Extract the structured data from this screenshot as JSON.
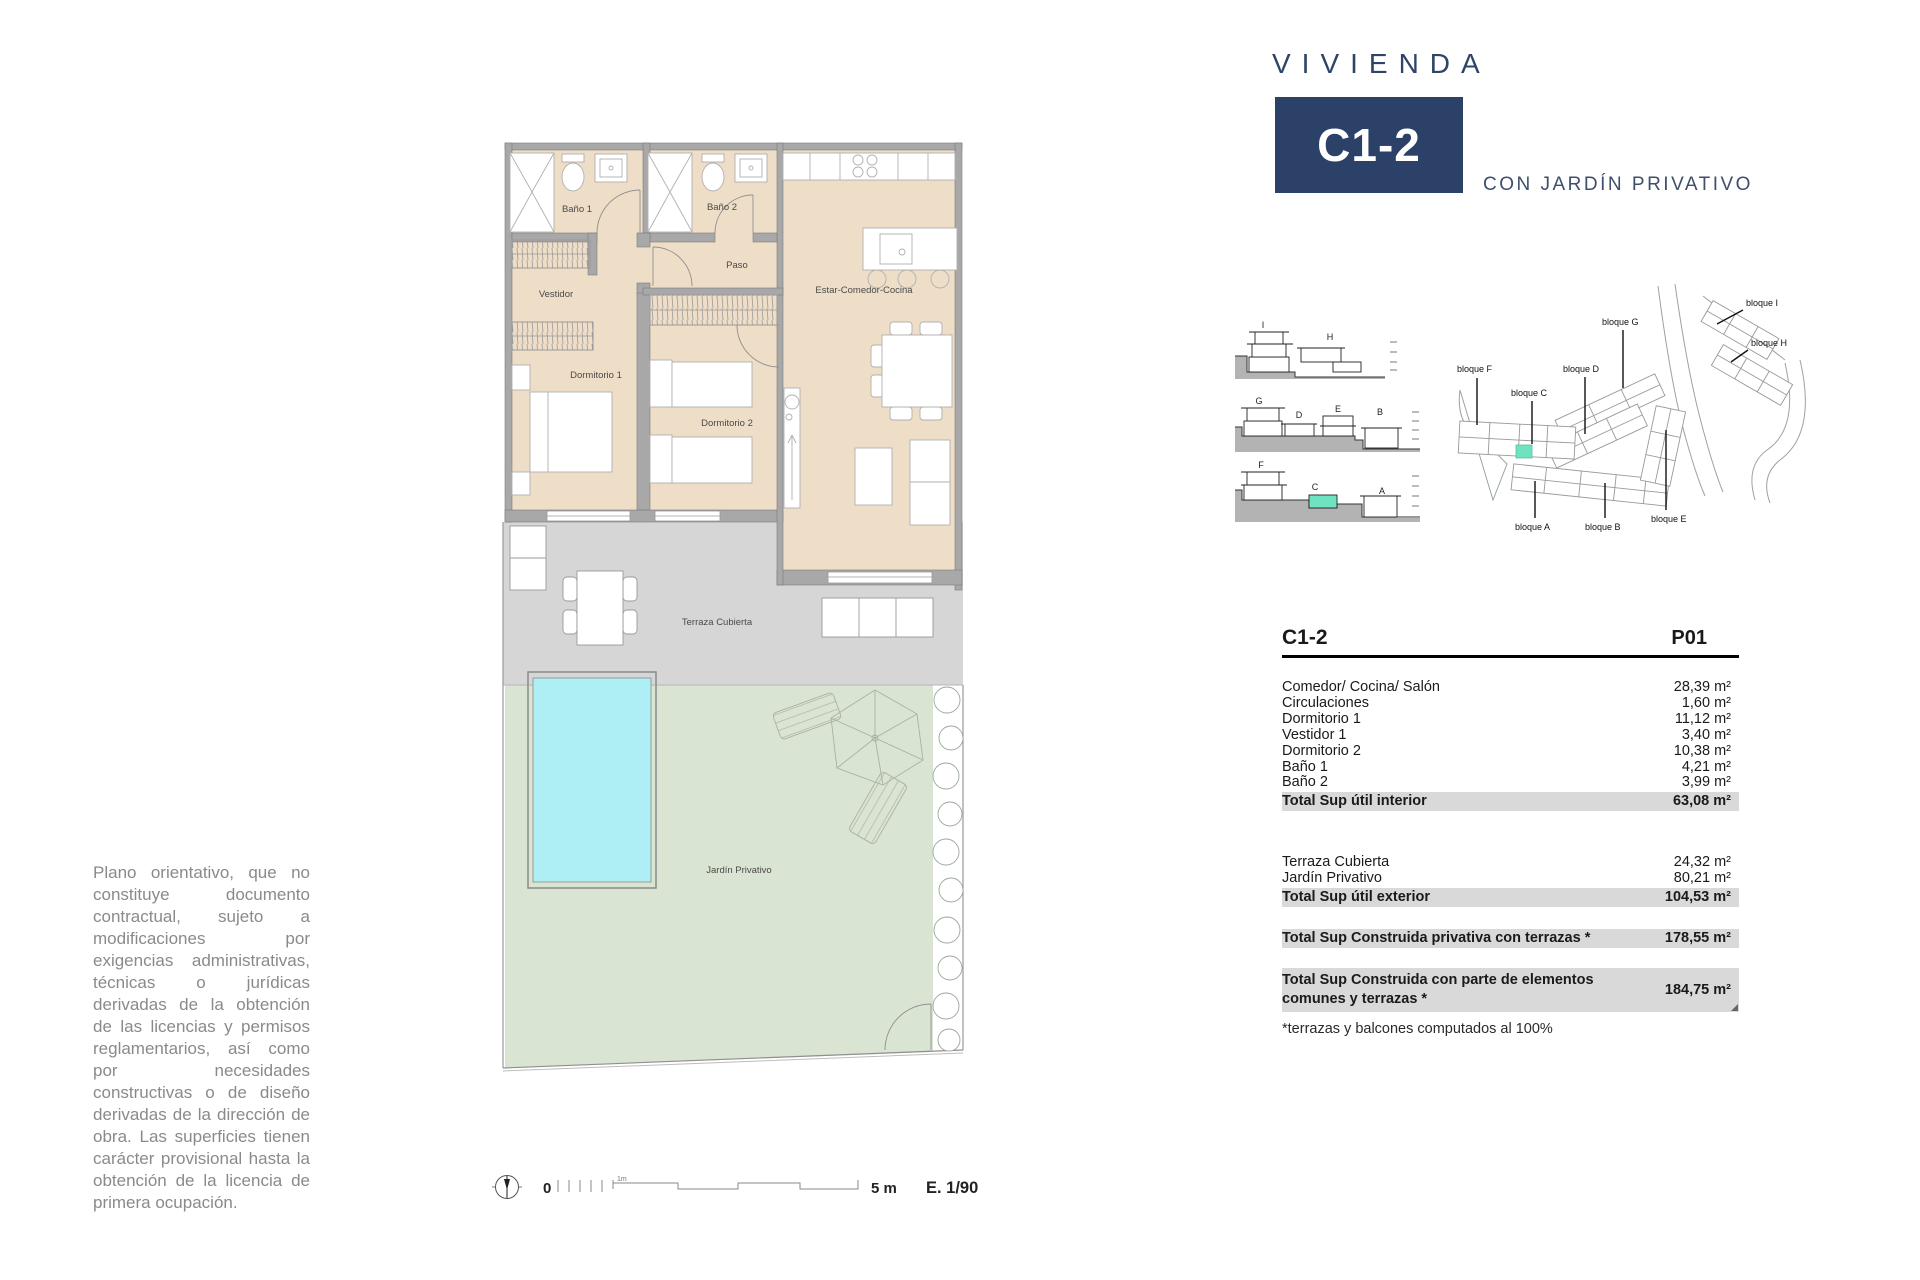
{
  "header": {
    "kicker": "VIVIENDA",
    "unit_code": "C1-2",
    "subtitle": "CON JARDÍN PRIVATIVO",
    "navy": "#2b4168"
  },
  "plan": {
    "room_labels": [
      "Baño 1",
      "Baño 2",
      "Paso",
      "Vestidor",
      "Estar-Comedor-Cocina",
      "Dormitorio 1",
      "Dormitorio 2",
      "Terraza Cubierta",
      "Jardín Privativo"
    ],
    "colors": {
      "floor": "#eeddc7",
      "wall": "#a8a8a8",
      "terrace": "#d6d6d6",
      "garden": "#dae4d3",
      "pool": "#aeeef5",
      "highlight": "#6fe3c1"
    },
    "scale_bar": {
      "zero": "0",
      "one_meter": "1m",
      "five_meters": "5 m",
      "ratio": "E. 1/90"
    }
  },
  "sections": {
    "labels": [
      "I",
      "H",
      "G",
      "D",
      "E",
      "B",
      "F",
      "C",
      "A"
    ]
  },
  "site_plan": {
    "labels": [
      "bloque F",
      "bloque C",
      "bloque D",
      "bloque G",
      "bloque I",
      "bloque H",
      "bloque A",
      "bloque B",
      "bloque E"
    ]
  },
  "area_table": {
    "unit_code": "C1-2",
    "floor_code": "P01",
    "interior_rows": [
      {
        "label": "Comedor/ Cocina/ Salón",
        "value": "28,39 m²"
      },
      {
        "label": "Circulaciones",
        "value": "1,60 m²"
      },
      {
        "label": "Dormitorio 1",
        "value": "11,12 m²"
      },
      {
        "label": "Vestidor 1",
        "value": "3,40 m²"
      },
      {
        "label": "Dormitorio 2",
        "value": "10,38 m²"
      },
      {
        "label": "Baño 1",
        "value": "4,21 m²"
      },
      {
        "label": "Baño 2",
        "value": "3,99 m²"
      }
    ],
    "interior_total": {
      "label": "Total Sup útil interior",
      "value": "63,08 m²"
    },
    "exterior_rows": [
      {
        "label": "Terraza Cubierta",
        "value": "24,32 m²"
      },
      {
        "label": "Jardín Privativo",
        "value": "80,21 m²"
      }
    ],
    "exterior_total": {
      "label": "Total Sup útil exterior",
      "value": "104,53 m²"
    },
    "built_private": {
      "label": "Total Sup Construida privativa con terrazas *",
      "value": "178,55 m²"
    },
    "built_common": {
      "label": "Total Sup Construida con parte de elementos comunes y terrazas *",
      "value": "184,75 m²"
    },
    "footnote": "*terrazas y balcones computados al 100%"
  },
  "disclaimer": "Plano orientativo, que no constituye documento contractual, sujeto a modificaciones por exigencias administrativas, técnicas o jurídicas derivadas de la obtención de las licencias y permisos reglamentarios, así como por necesidades constructivas o de diseño derivadas de la dirección de obra. Las superficies tienen carácter provisional hasta la obtención de la licencia de primera ocupación."
}
